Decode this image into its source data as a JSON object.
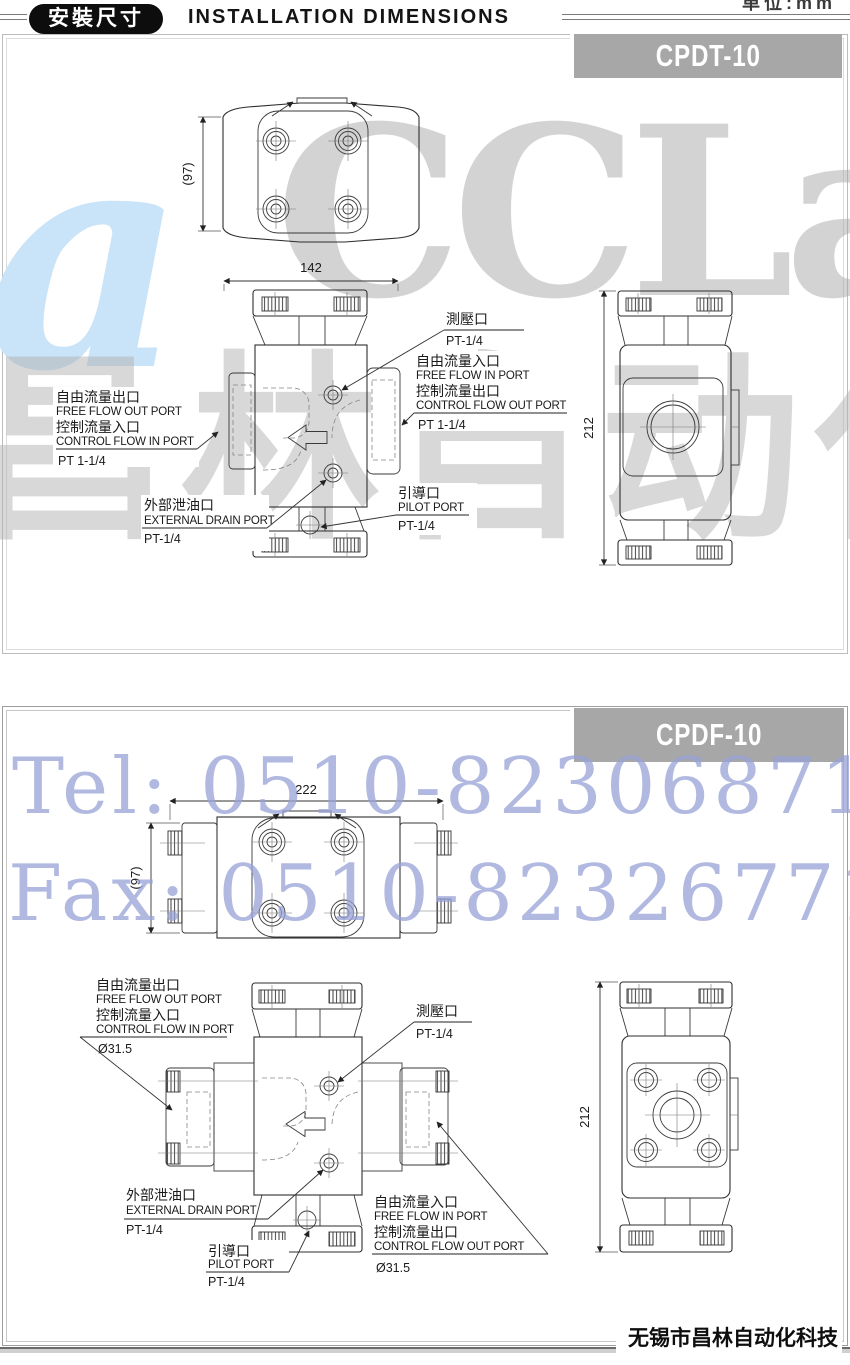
{
  "header": {
    "badge": "安裝尺寸",
    "title": "INSTALLATION DIMENSIONS",
    "unit_note": "单位:mm"
  },
  "watermarks": {
    "logo_glyph": "a",
    "logo_text": "CCLair",
    "logo_cn": "昌林自动化",
    "tel": "Tel: 0510-82306871",
    "fax": "Fax: 0510-82326771"
  },
  "footer": {
    "company": "无锡市昌林自动化科技"
  },
  "sections": [
    {
      "model": "CPDT-10",
      "dimensions": {
        "top_width": "142",
        "top_depth": "(97)",
        "side_height": "212"
      },
      "callouts": {
        "gauge": {
          "cn": "測壓口",
          "size": "PT-1/4"
        },
        "free_in": {
          "cn": "自由流量入口",
          "en": "FREE FLOW IN PORT"
        },
        "ctrl_out": {
          "cn": "控制流量出口",
          "en": "CONTROL FLOW OUT PORT",
          "size": "PT 1-1/4"
        },
        "free_out": {
          "cn": "自由流量出口",
          "en": "FREE FLOW OUT PORT"
        },
        "ctrl_in": {
          "cn": "控制流量入口",
          "en": "CONTROL FLOW IN PORT",
          "size": "PT 1-1/4"
        },
        "drain": {
          "cn": "外部泄油口",
          "en": "EXTERNAL DRAIN PORT",
          "size": "PT-1/4"
        },
        "pilot": {
          "cn": "引導口",
          "en": "PILOT PORT",
          "size": "PT-1/4"
        }
      }
    },
    {
      "model": "CPDF-10",
      "dimensions": {
        "top_width": "222",
        "top_depth": "(97)",
        "side_height": "212"
      },
      "callouts": {
        "gauge": {
          "cn": "測壓口",
          "size": "PT-1/4"
        },
        "free_in": {
          "cn": "自由流量入口",
          "en": "FREE FLOW IN PORT"
        },
        "ctrl_out": {
          "cn": "控制流量出口",
          "en": "CONTROL FLOW OUT PORT",
          "size": "Ø31.5"
        },
        "free_out": {
          "cn": "自由流量出口",
          "en": "FREE FLOW OUT PORT"
        },
        "ctrl_in": {
          "cn": "控制流量入口",
          "en": "CONTROL FLOW IN PORT",
          "size": "Ø31.5"
        },
        "drain": {
          "cn": "外部泄油口",
          "en": "EXTERNAL DRAIN PORT",
          "size": "PT-1/4"
        },
        "pilot": {
          "cn": "引導口",
          "en": "PILOT PORT",
          "size": "PT-1/4"
        }
      }
    }
  ]
}
